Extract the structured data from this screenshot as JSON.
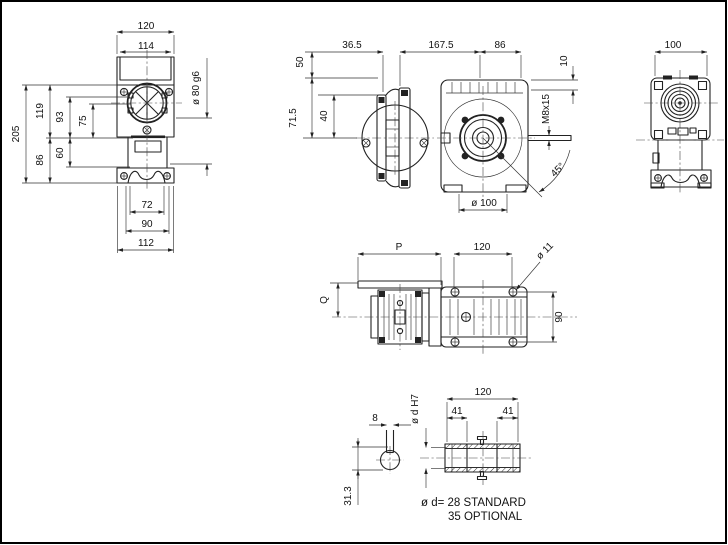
{
  "front_view": {
    "d120": "120",
    "d114": "114",
    "d205": "205",
    "d119": "119",
    "d93": "93",
    "d75": "75",
    "d86": "86",
    "d60": "60",
    "d72": "72",
    "d90": "90",
    "d112": "112",
    "spigot": "ø 80 g6"
  },
  "side_view": {
    "d50": "50",
    "d36_5": "36.5",
    "d167_5": "167.5",
    "d86": "86",
    "d10": "10",
    "d71_5": "71.5",
    "d40": "40",
    "m8": "M8x15",
    "angle": "45°",
    "dia100": "ø 100"
  },
  "end_view": {
    "d100": "100"
  },
  "plan_view": {
    "p": "P",
    "d120": "120",
    "dia11": "ø 11",
    "q": "Q",
    "d90": "90"
  },
  "shaft_detail": {
    "d120": "120",
    "d41a": "41",
    "d41b": "41",
    "bore": "ø d H7",
    "key_w": "8",
    "key_t": "31.3",
    "note1": "ø d= 28 STANDARD",
    "note2": "35 OPTIONAL"
  }
}
